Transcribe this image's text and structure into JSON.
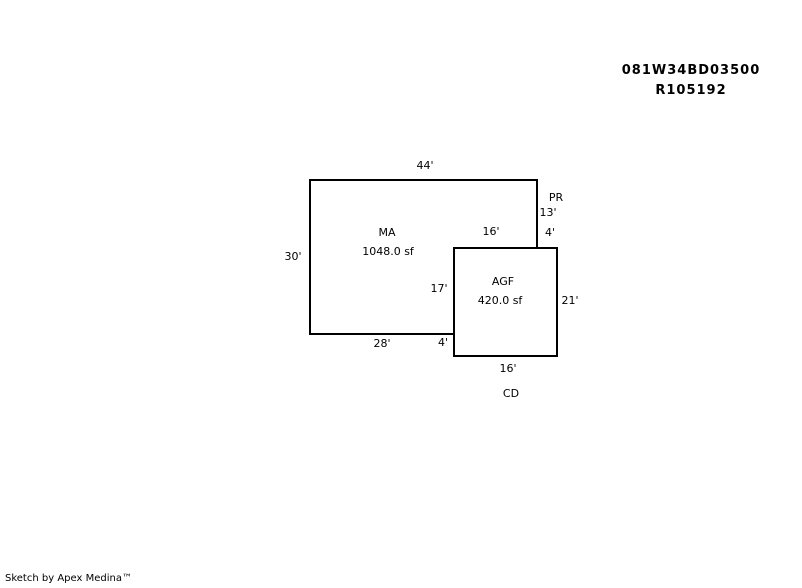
{
  "parcel": {
    "id": "081W34BD03500",
    "account": "R105192"
  },
  "sketch": {
    "ma": {
      "code": "MA",
      "area": "1048.0 sf"
    },
    "agf": {
      "code": "AGF",
      "area": "420.0 sf"
    },
    "pr": {
      "code": "PR"
    },
    "cd": {
      "code": "CD"
    },
    "dims": {
      "ma_top": "44'",
      "ma_left": "30'",
      "ma_bottom": "28'",
      "ma_bottom_step": "4'",
      "pr_height": "13'",
      "pr_width": "4'",
      "agf_top": "16'",
      "agf_left": "17'",
      "agf_right": "21'",
      "agf_bottom": "16'"
    }
  },
  "footer": {
    "credit": "Sketch by Apex Medina™"
  },
  "colors": {
    "line": "#000000",
    "background": "#ffffff"
  }
}
